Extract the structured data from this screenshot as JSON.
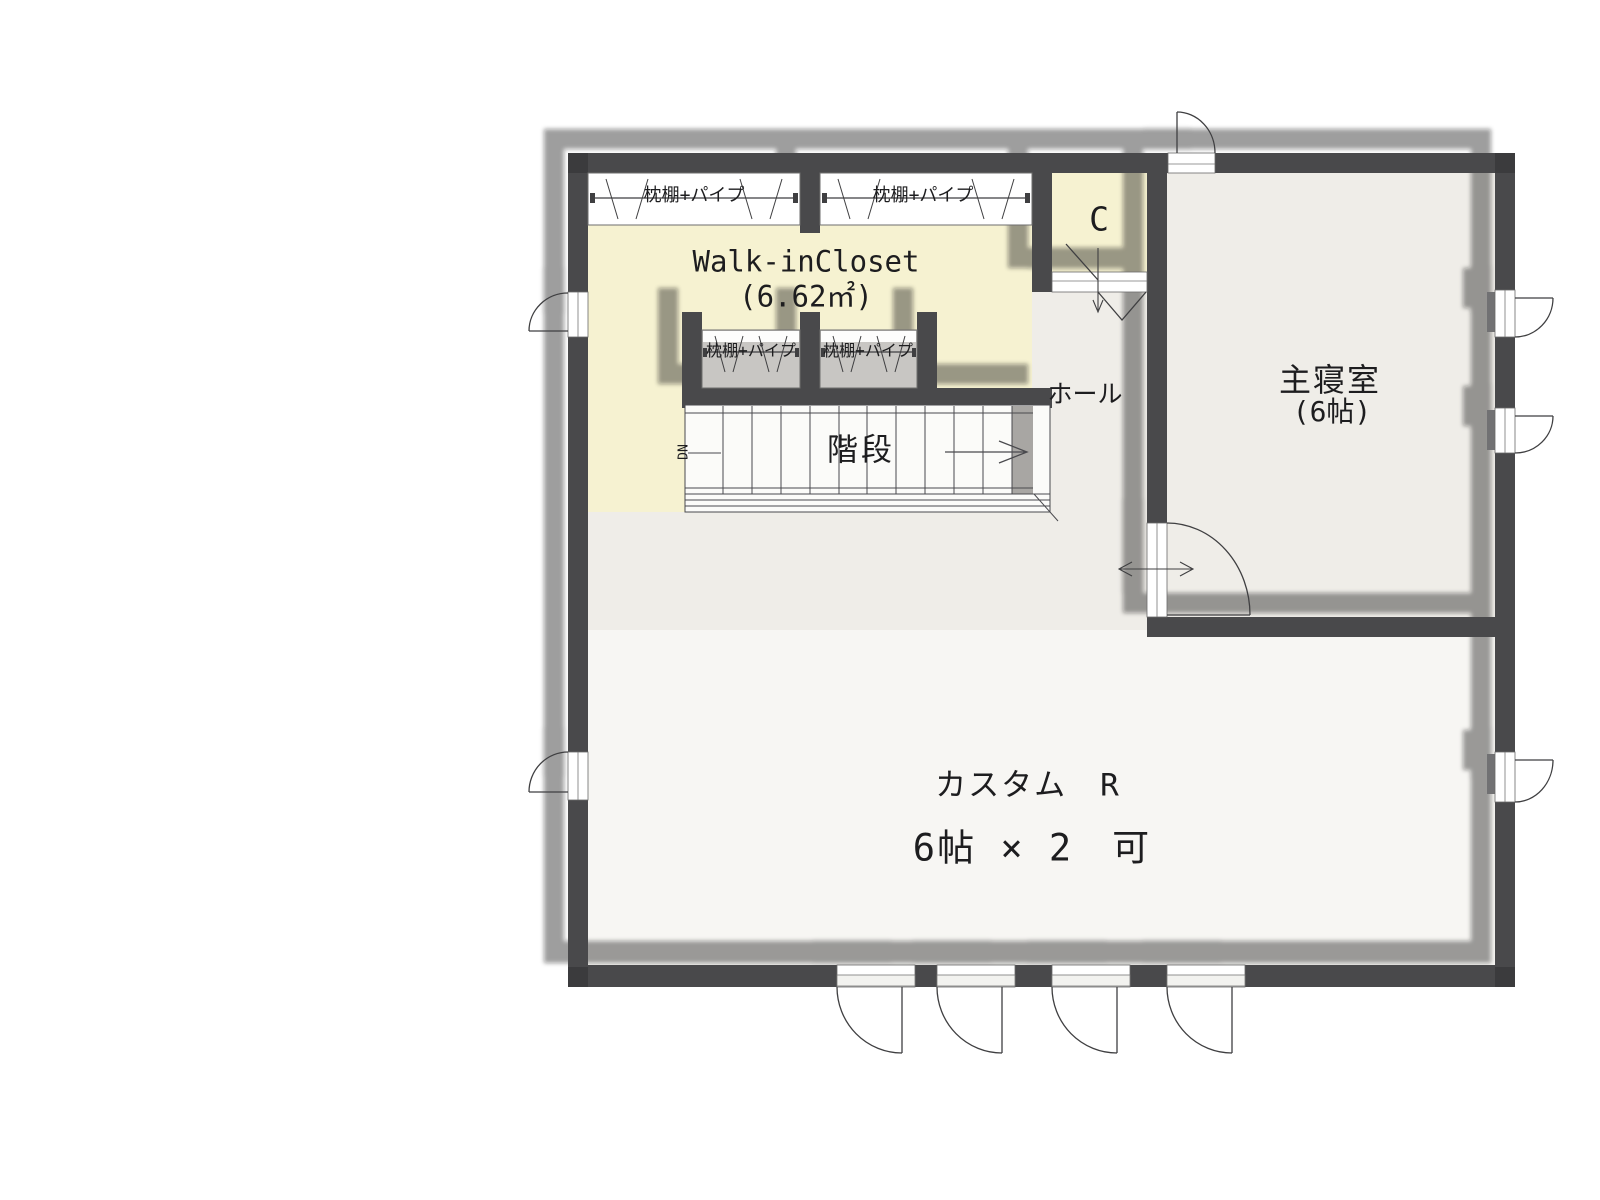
{
  "plan": {
    "rooms": {
      "walk_in_closet": {
        "name": "Walk-inCloset",
        "area": "(6.62㎡)"
      },
      "closet_c": {
        "label": "C"
      },
      "hall": {
        "label": "ホール"
      },
      "master_bedroom": {
        "name": "主寝室",
        "size": "(6帖)"
      },
      "stairs": {
        "label": "階段",
        "direction": "DN"
      },
      "custom_room": {
        "name": "カスタム　R",
        "size": "6帖 × 2　可"
      }
    },
    "fixtures": {
      "closet_shelf_pipe": "枕棚+パイプ"
    },
    "colors": {
      "wall": "#4a4a4c",
      "wic_floor": "#f6f2d1",
      "room_floor": "#efede8",
      "custom_room_floor": "#f7f6f3",
      "closet_floor": "#c8c6c3",
      "shadow": "rgba(20,20,20,0.42)"
    }
  }
}
